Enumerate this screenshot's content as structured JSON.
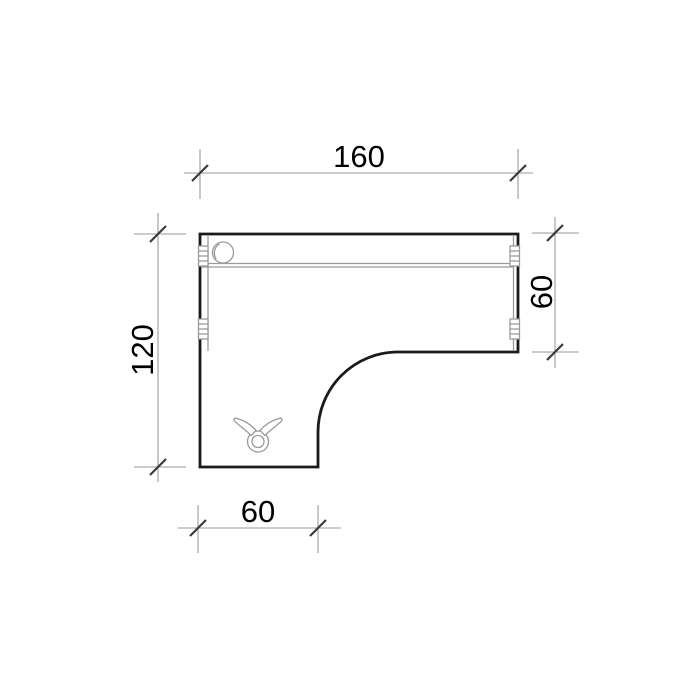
{
  "drawing": {
    "dimensions": {
      "top": {
        "value": "160",
        "orientation": "horizontal",
        "measures": "overall width"
      },
      "right": {
        "value": "60",
        "orientation": "vertical",
        "measures": "top section depth"
      },
      "left": {
        "value": "120",
        "orientation": "vertical",
        "measures": "overall depth"
      },
      "bottom": {
        "value": "60",
        "orientation": "horizontal",
        "measures": "left section width"
      }
    },
    "symbols": [
      "cable-port-symbol",
      "leg-mount-symbol",
      "panel-connector-symbol",
      "cable-channel-lines",
      "panel-joint-line"
    ],
    "colors": {
      "background": "#ffffff",
      "outline": "#1a1a1a",
      "detail": "#9a9a9a",
      "dimension_line": "#9a9a9a",
      "tick": "#3a3a3a",
      "text": "#000000"
    }
  }
}
